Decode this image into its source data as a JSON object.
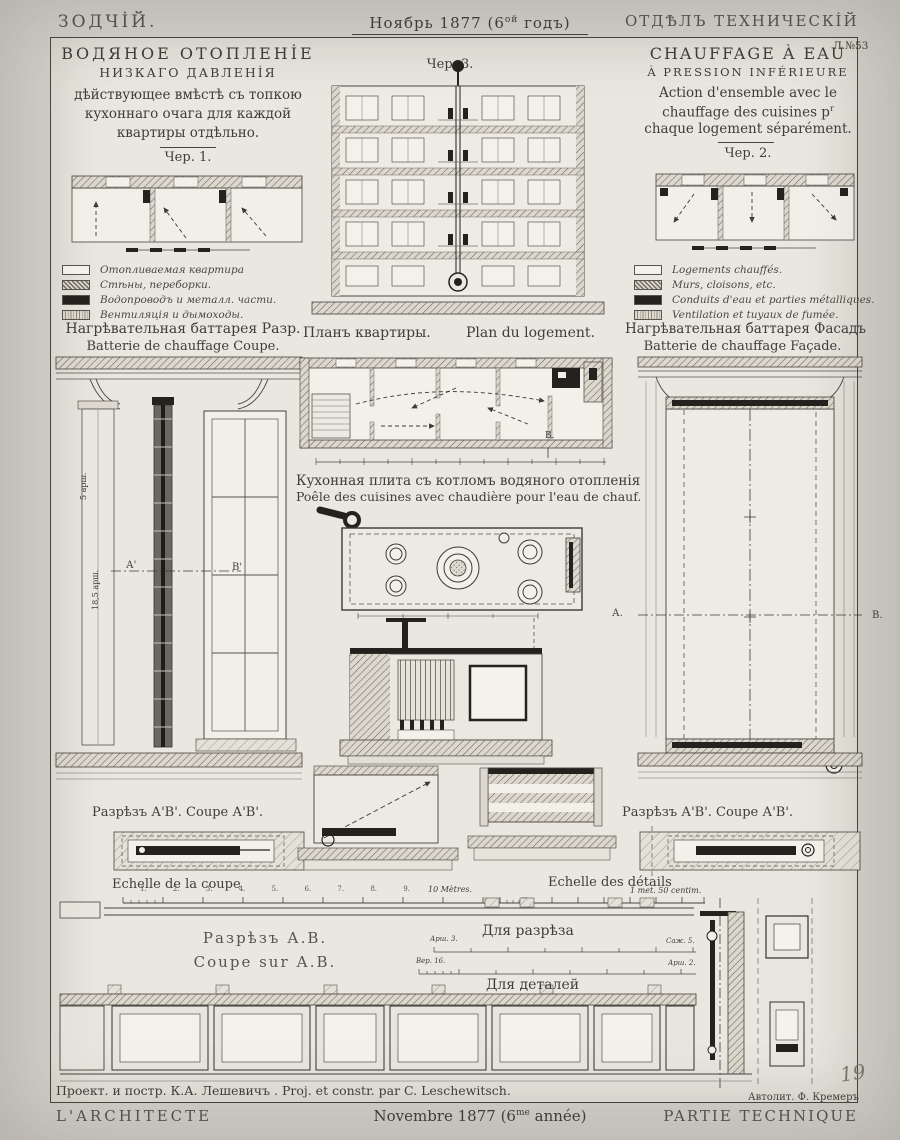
{
  "colors": {
    "paper": "#d2d0c9",
    "plate": "#e9e7e0",
    "ink": "#3f3d36",
    "black": "#23221f"
  },
  "masthead": {
    "left": "ЗОДЧİЙ.",
    "center_a": "Ноябрь 1877 (6",
    "center_sup": "ой",
    "center_b": " годъ)",
    "right": "ОТДѢЛЪ ТЕХНИЧЕСКİЙ",
    "plate_no": "Л.№53"
  },
  "footer": {
    "left": "L'ARCHITECTE",
    "center_a": "Novembre 1877 (6",
    "center_sup": "me",
    "center_b": " année)",
    "right": "PARTIE TECHNIQUE"
  },
  "credits": {
    "project": "Проект. и постр. К.А. Лешевичъ . Proj. et constr. par C. Leschewitsch.",
    "lithographer": "Автолит. Ф. Кремеръ",
    "page_number": "19"
  },
  "left_panel": {
    "title1": "ВОДЯНОЕ ОТОПЛЕНİЕ",
    "title2": "НИЗКАГО ДАВЛЕНİЯ",
    "sub1": "дѣйствующее вмѣстѣ съ топкою",
    "sub2": "кухоннаго очага для каждой",
    "sub3": "квартиры отдѣльно.",
    "fig": "Чер. 1.",
    "legend": [
      {
        "label": "Отопливаемая квартира"
      },
      {
        "label": "Стѣны, переборки."
      },
      {
        "label": "Водопроводъ и металл. части."
      },
      {
        "label": "Вентиляція и дымоходы."
      }
    ],
    "cap_ru": "Нагрѣвательная баттарея Разр.",
    "cap_fr": "Batterie de chauffage Coupe.",
    "dim1": "5 арш.",
    "dim2": "18,5 арш.",
    "marker_a": "А'",
    "marker_b": "В'",
    "section_cap": "Разрѣзъ А'В'. Coupe А'В'.",
    "scale_title": "Echelle de la coupe",
    "scale_ticks": "1. 2. 3. 4. 5. 6. 7. 8. 9.",
    "scale_end": "10 Mètres."
  },
  "right_panel": {
    "title1": "CHAUFFAGE À EAU",
    "title2": "À PRESSION INFÉRIEURE",
    "sub1": "Action d'ensemble avec le",
    "sub2_a": "chauffage des cuisines p",
    "sub2_sup": "r",
    "sub3": "chaque logement séparément.",
    "fig": "Чер. 2.",
    "legend": [
      {
        "label": "Logements chauffés."
      },
      {
        "label": "Murs, cloisons, etc."
      },
      {
        "label": "Conduits d'eau et parties métalliques."
      },
      {
        "label": "Ventilation et tuyaux de fumée."
      }
    ],
    "cap_ru": "Нагрѣвательная баттарея Фасадъ",
    "cap_fr": "Batterie de chauffage Façade.",
    "marker_a": "А.",
    "marker_b": "В.",
    "section_cap": "Разрѣзъ А'В'. Coupe А'В'.",
    "scale_title": "Echelle des détails",
    "scale_end": "1 met. 50 centim."
  },
  "center": {
    "fig": "Чер. 3.",
    "plan_ru": "Планъ квартиры.",
    "plan_fr": "Plan du logement.",
    "plan_marker": "В.",
    "stove_ru": "Кухонная плита съ котломъ водяного отопленія",
    "stove_fr": "Poêle des cuisines avec chaudière pour l'eau de chauf."
  },
  "bottom": {
    "sec_ru": "Разрѣзъ А.В.",
    "sec_fr": "Coupe sur А.В.",
    "scale1_label": "Для разрѣза",
    "scale1_left": "Арш. 3.",
    "scale1_right": "Саж. 5.",
    "scale2_label": "Для деталей",
    "scale2_left": "Вер. 16.",
    "scale2_right": "Арш. 2."
  }
}
